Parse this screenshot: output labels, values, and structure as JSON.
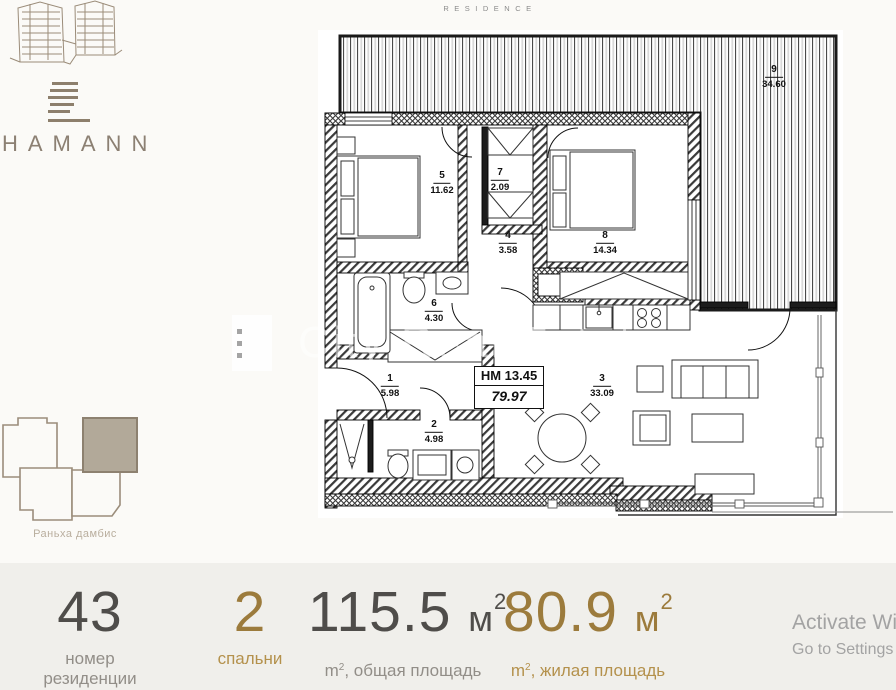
{
  "brand": {
    "name": "HAMANN",
    "residence_label": "RESIDENCE"
  },
  "floor_plan": {
    "unit_box": {
      "line1": "HM 13.45",
      "line2": "79.97"
    },
    "rooms": [
      {
        "num": "1",
        "area": "5.98"
      },
      {
        "num": "2",
        "area": "4.98"
      },
      {
        "num": "3",
        "area": "33.09"
      },
      {
        "num": "4",
        "area": "3.58"
      },
      {
        "num": "5",
        "area": "11.62"
      },
      {
        "num": "6",
        "area": "4.30"
      },
      {
        "num": "7",
        "area": "2.09"
      },
      {
        "num": "8",
        "area": "14.34"
      },
      {
        "num": "9",
        "area": "34.60"
      }
    ]
  },
  "watermark": {
    "text": "City Real Estate"
  },
  "site_plan": {
    "caption": "Раньха дамбис"
  },
  "stats": {
    "residence_number": {
      "value": "43",
      "label": "номер резиденции"
    },
    "bedrooms": {
      "value": "2",
      "label": "спальни"
    },
    "total_area": {
      "value": "115.5",
      "unit": "м",
      "unit_sup": "2",
      "label_unit": "m",
      "label_unit_sup": "2",
      "label_text": ", общая площадь"
    },
    "living_area": {
      "value": "80.9",
      "unit": "м",
      "unit_sup": "2",
      "label_unit": "m",
      "label_unit_sup": "2",
      "label_text": ", жилая площадь"
    }
  },
  "activation": {
    "line1": "Activate Win",
    "line2": "Go to Settings t"
  },
  "colors": {
    "accent_gold": "#9c7b3c",
    "brand_taupe": "#8c8073",
    "highlight_unit": "#b2a999"
  }
}
